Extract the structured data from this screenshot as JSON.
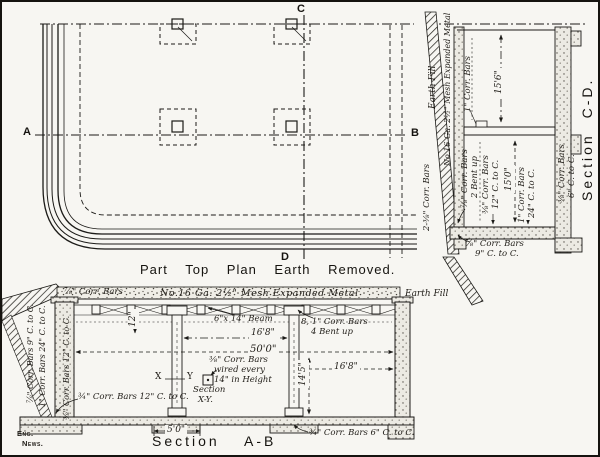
{
  "colors": {
    "paper": "#f7f6f2",
    "ink": "#1c1b18"
  },
  "credit": {
    "line1": "Eng.",
    "line2": "News."
  },
  "plan": {
    "title": "Part Top Plan Earth Removed.",
    "marker_a": "A",
    "marker_b": "B",
    "marker_c": "C",
    "marker_d": "D"
  },
  "section_cd": {
    "title": "Section C-D.",
    "earth_fill": "Earth Fill",
    "mesh": "No.16 Ga. 2½\" Mesh Expanded Metal",
    "outer_bars": "2-⅜\" Corr. Bars",
    "roof_bars": "1\" Corr. Bars",
    "dim_upper": "15'6\"",
    "dim_lower": "15'0\"",
    "bent_l1": "⅞\" Corr. Bars",
    "bent_l2": "2 Bent up",
    "slab_a_l1": "⅜\" Corr. Bars",
    "slab_a_l2": "12\" C. to C.",
    "slab_b_l1": "1\" Corr. Bars",
    "slab_b_l2": "24\" C. to C.",
    "wall_l1": "⅜\" Corr. Bars",
    "wall_l2": "6\" C. to C.",
    "bottom_l1": "⅞\" Corr. Bars",
    "bottom_l2": "9\" C. to C."
  },
  "section_ab": {
    "title_word": "Section",
    "title_letters": "A-B",
    "roof_bars": "⅞\" Corr. Bars",
    "mesh": "No.16 Ga. 2½\" Mesh Expanded Metal",
    "earth_fill": "Earth Fill",
    "dim_12": "12\"",
    "beam": "6\"x 14\" Beam",
    "bent_l1": "8, 1\" Corr. Bars",
    "bent_l2": "4 Bent up",
    "dim_16_8_a": "16'8\"",
    "dim_50": "50'0\"",
    "dim_16_8_b": "16'8\"",
    "dim_14_5": "14'5\"",
    "dim_5_0": "5'0\"",
    "wired_l1": "⅜\" Corr. Bars",
    "wired_l2": "wired every",
    "wired_l3": "14\" in Height",
    "xy_l1": "Section",
    "xy_l2": "X-Y.",
    "x": "X",
    "y": "Y",
    "wall_out1": "⅞\" Corr. Bars 9\" C. to C.",
    "wall_out2": "1\" Corr. Bars 24\" C. to C.",
    "wall_in": "⅜\" Corr. Bars 12\" C. to C.",
    "floor_left": "¾\" Corr. Bars 12\" C. to C.",
    "floor_right": "¾\" Corr. Bars 6\" C. to C."
  }
}
